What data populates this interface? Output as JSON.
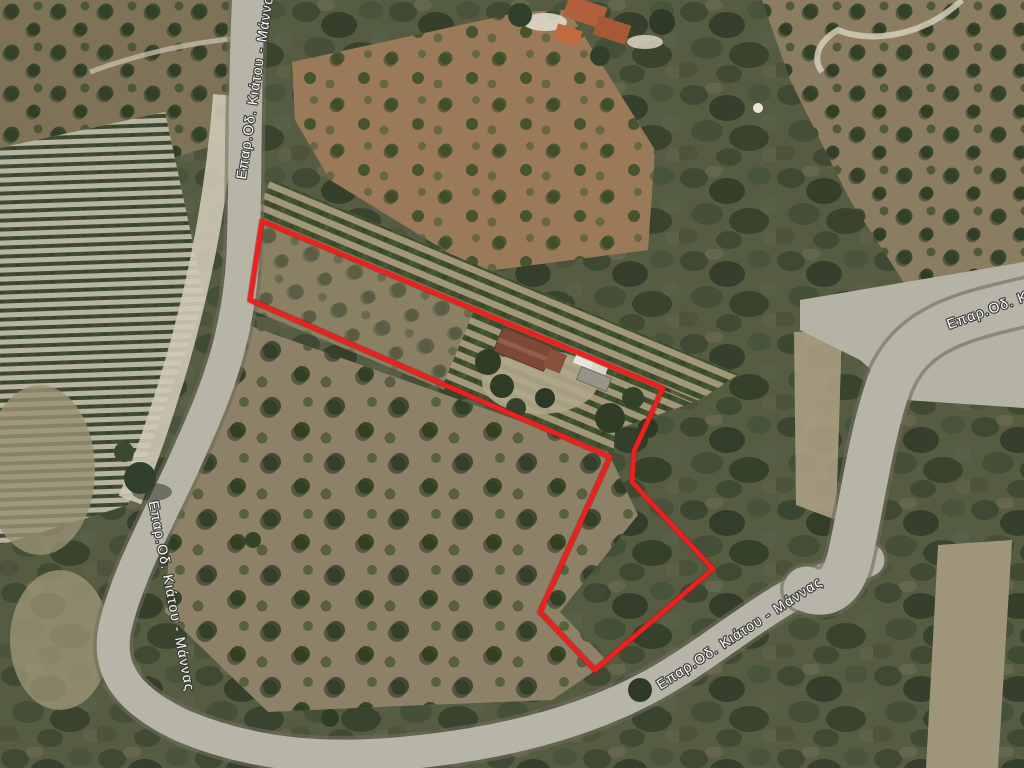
{
  "road_labels": [
    {
      "id": "top-left",
      "text": "Επαρ.Οδ. Κιάτου - Μάννας"
    },
    {
      "id": "right",
      "text": "Επαρ.Οδ. Κιάτου - Μάννας"
    },
    {
      "id": "bottom-right",
      "text": "Επαρ.Οδ. Κιάτου - Μάννας"
    },
    {
      "id": "bottom-left",
      "text": "Επαρ.Οδ. Κιάτου - Μάννας"
    }
  ],
  "parcel": {
    "outline_color": "#e8231f",
    "points": "262,221 663,388 634,451 632,482 713,569 595,670 540,612 610,457 250,300"
  }
}
